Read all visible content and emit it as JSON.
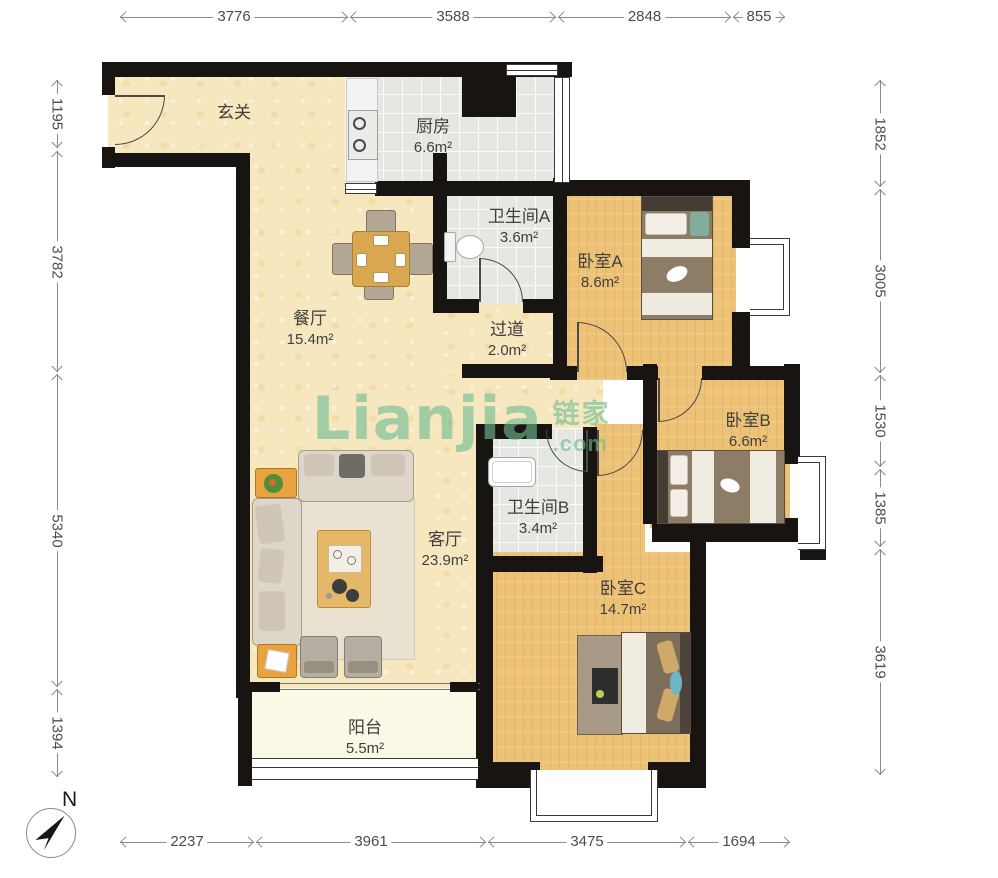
{
  "rooms": {
    "entrance": {
      "name": "玄关",
      "area": ""
    },
    "kitchen": {
      "name": "厨房",
      "area": "6.6m²"
    },
    "bath_a": {
      "name": "卫生间A",
      "area": "3.6m²"
    },
    "bed_a": {
      "name": "卧室A",
      "area": "8.6m²"
    },
    "dining": {
      "name": "餐厅",
      "area": "15.4m²"
    },
    "hallway": {
      "name": "过道",
      "area": "2.0m²"
    },
    "bed_b": {
      "name": "卧室B",
      "area": "6.6m²"
    },
    "bath_b": {
      "name": "卫生间B",
      "area": "3.4m²"
    },
    "living": {
      "name": "客厅",
      "area": "23.9m²"
    },
    "bed_c": {
      "name": "卧室C",
      "area": "14.7m²"
    },
    "balcony": {
      "name": "阳台",
      "area": "5.5m²"
    }
  },
  "dimensions_mm": {
    "top": [
      "3776",
      "3588",
      "2848",
      "855"
    ],
    "left": [
      "1195",
      "3782",
      "5340",
      "1394"
    ],
    "right": [
      "1852",
      "3005",
      "1530",
      "1385",
      "3619"
    ],
    "bottom": [
      "2237",
      "3961",
      "3475",
      "1694"
    ]
  },
  "compass": {
    "label": "N"
  },
  "watermark": {
    "brand": "Lianjia",
    "brand_cn": "链家",
    "suffix": ".com",
    "color": "#6fbd92"
  }
}
